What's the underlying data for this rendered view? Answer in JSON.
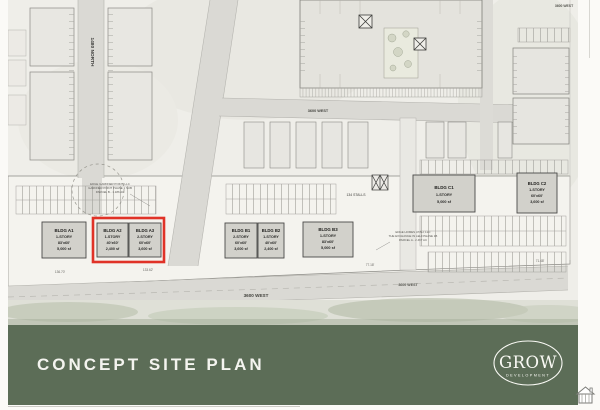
{
  "banner": {
    "title": "CONCEPT SITE PLAN",
    "logo": {
      "name": "GROW",
      "subtitle": "DEVELOPMENT"
    }
  },
  "colors": {
    "banner_green": "#5c6d57",
    "highlight_red": "#e03227",
    "street_gray": "#dad9d4",
    "building_gray": "#d2d1cb"
  },
  "streets": {
    "north": "1480 NORTH",
    "west": "3600 WEST"
  },
  "parking": {
    "stalls_label": "134 STALLS"
  },
  "parcels": {
    "left": {
      "line1": "EDGE GARDNER POINT, LLC",
      "line2": "GARDNER POINT PHASE 1 SUB",
      "line3": "PARCEL B - 1.186 AC"
    },
    "right": {
      "line1": "EDGE HOMES UTAH, LLC",
      "line2": "THE EXCHANGE IN LEHI PHASE 1B",
      "line3": "PARCEL A - 2.467 AC"
    }
  },
  "dimensions": {
    "d1": "136.70'",
    "d2": "133.62'",
    "d3": "77.18'",
    "d4": "71.48'"
  },
  "buildings": [
    {
      "id": "A1",
      "name": "BLDG A1",
      "story": "1-STORY",
      "dims": "83'x60'",
      "area": "5,000 sf",
      "highlighted": false
    },
    {
      "id": "A2",
      "name": "BLDG A2",
      "story": "1-STORY",
      "dims": "40'x60'",
      "area": "2,400 sf",
      "highlighted": true
    },
    {
      "id": "A3",
      "name": "BLDG A3",
      "story": "2-STORY",
      "dims": "60'x60'",
      "area": "3,600 sf",
      "highlighted": true
    },
    {
      "id": "B1",
      "name": "BLDG B1",
      "story": "2-STORY",
      "dims": "60'x60'",
      "area": "3,600 sf",
      "highlighted": false
    },
    {
      "id": "B2",
      "name": "BLDG B2",
      "story": "1-STORY",
      "dims": "40'x60'",
      "area": "2,400 sf",
      "highlighted": false
    },
    {
      "id": "B3",
      "name": "BLDG B3",
      "story": "1-STORY",
      "dims": "83'x60'",
      "area": "5,000 sf",
      "highlighted": false
    },
    {
      "id": "C1",
      "name": "BLDG C1",
      "story": "1-STORY",
      "dims": "",
      "area": "5,000 sf",
      "highlighted": false
    },
    {
      "id": "C2",
      "name": "BLDG C2",
      "story": "1-STORY",
      "dims": "60'x60'",
      "area": "3,600 sf",
      "highlighted": false
    }
  ]
}
